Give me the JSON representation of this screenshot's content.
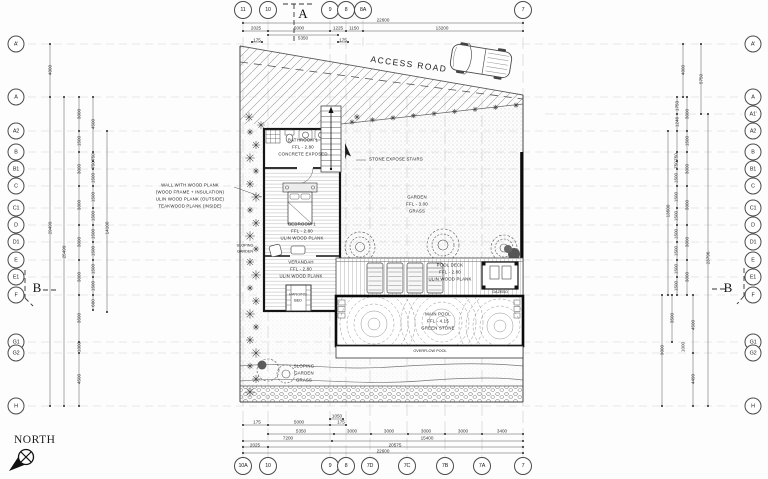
{
  "north_label": "NORTH",
  "access_road": {
    "label": "ACCESS ROAD"
  },
  "wall_note": {
    "lines": [
      "WALL WITH WOOD PLANK",
      "(WOOD FRAME + INSULATION)",
      "ULIN WOOD PLANK (OUTSIDE)",
      "TEAKWOOD PLANK (INSIDE)"
    ]
  },
  "rooms": {
    "bathroom": {
      "name": "BATHROOM 1",
      "level": "FFL - 2.80",
      "finish": "CONCRETE EXPOSED"
    },
    "bedroom": {
      "name": "BEDROOM 1",
      "level": "FFL - 2.80",
      "finish": "ULIN WOOD PLANK"
    },
    "verandah": {
      "name": "VERANDAH",
      "level": "FFL - 2.80",
      "finish": "ULIN WOOD PLANK"
    },
    "hanging_bed": {
      "name": "HANGING BED"
    },
    "stairs": {
      "name": "STONE EXPOSE STAIRS"
    },
    "garden": {
      "name": "GARDEN",
      "level": "FFL - 3.00",
      "finish": "GRASS"
    },
    "pool_deck": {
      "name": "POOL DECK",
      "level": "FFL - 2.80",
      "finish": "ULIN WOOD PLANK"
    },
    "gazebo": {
      "name": "GAZEBO"
    },
    "main_pool": {
      "name": "MAIN POOL",
      "level": "FFL - 4.15",
      "finish": "GREEN STONE"
    },
    "overflow_pool": {
      "name": "OVERFLOW POOL"
    },
    "sloping_garden": {
      "lines": [
        "SLOPING",
        "GARDEN",
        "GRASS"
      ]
    },
    "sloping_strip": {
      "lines": [
        "SLOPING",
        "GARDEN"
      ]
    }
  },
  "sections": {
    "top": "A",
    "left": "B",
    "right": "B"
  },
  "grid": {
    "top": [
      "11",
      "10",
      "9",
      "8",
      "8A",
      "7"
    ],
    "bottom": [
      "10A",
      "10",
      "9",
      "8",
      "7D",
      "7C",
      "7B",
      "7A",
      "7"
    ],
    "left": [
      "A'",
      "A",
      "A2",
      "B",
      "B1",
      "C",
      "C1",
      "D",
      "D1",
      "E",
      "E1",
      "F",
      "G1",
      "G2",
      "H"
    ],
    "right": [
      "A'",
      "A",
      "A1'",
      "A2",
      "B",
      "B1",
      "C",
      "C1",
      "D",
      "D1",
      "E",
      "E1",
      "F",
      "G1",
      "G2",
      "H"
    ]
  },
  "dimensions": {
    "top": [
      "22600",
      "2025",
      "5000",
      "1225",
      "1150",
      "13200",
      "5350",
      "175",
      "175"
    ],
    "bottom": [
      "1050",
      "175",
      "5000",
      "175",
      "5350",
      "3000",
      "3000",
      "3000",
      "3000",
      "3400",
      "7200",
      "15400",
      "2025",
      "20575",
      "22600"
    ],
    "left": [
      "4000",
      "29499",
      "25499",
      "3000",
      "1500",
      "3000",
      "3000",
      "3000",
      "3000",
      "3500",
      "1000",
      "4500",
      "4500",
      "750",
      "750",
      "1500",
      "1500",
      "1500",
      "1500",
      "1500",
      "1500",
      "1500",
      "600",
      "14100"
    ],
    "right": [
      "4000",
      "5750",
      "1753",
      "3000",
      "1246",
      "1500",
      "750",
      "750",
      "3000",
      "1500",
      "1500",
      "3000",
      "1500",
      "1500",
      "3000",
      "1500",
      "1500",
      "3000",
      "1500",
      "13500",
      "23796",
      "3500",
      "4500",
      "1000",
      "9000",
      "4499"
    ]
  },
  "colors": {
    "line": "#3c3c3c",
    "pool_border": "#0b0b0b",
    "grid": "#cccccc"
  }
}
